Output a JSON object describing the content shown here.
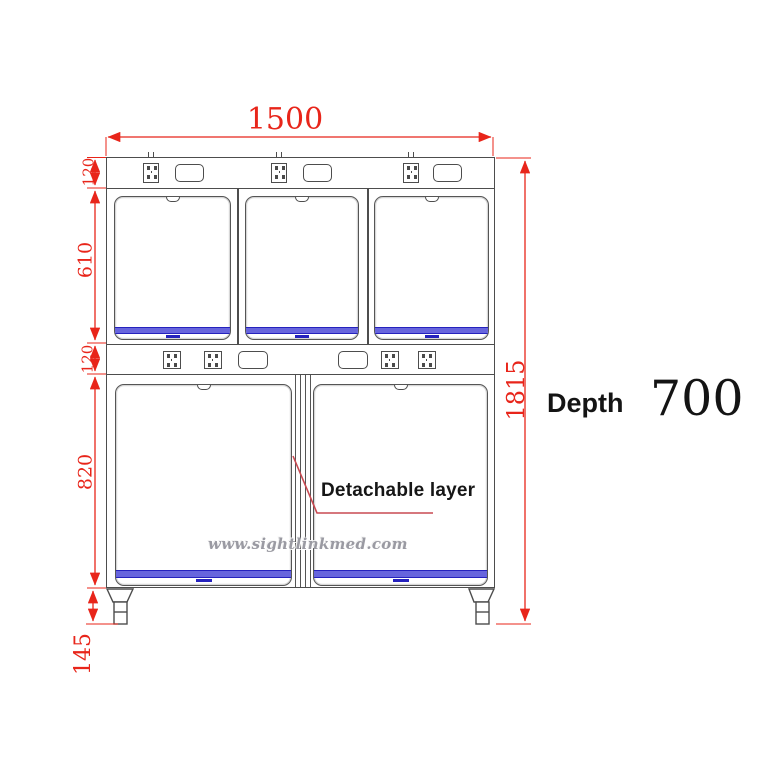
{
  "drawing": {
    "type": "technical-dimension-drawing",
    "subject": "veterinary cage bank, front elevation",
    "dimensions": {
      "total_width": "1500",
      "top_panel_height": "120",
      "upper_cage_height": "610",
      "middle_panel_height": "120",
      "lower_cage_height": "820",
      "leg_height": "145",
      "total_height": "1815"
    },
    "depth": {
      "label": "Depth",
      "value": "700"
    },
    "callout": "Detachable layer",
    "watermark": "www.sightlinkmed.com",
    "icons": {
      "socket": "power-socket-icon",
      "vent": "vent-panel-icon",
      "latch": "door-latch-notch"
    },
    "colors": {
      "dimension_red": "#e8251a",
      "line_gray": "#4d4d4d",
      "tray_blue_fill": "#6765dd",
      "tray_blue_line": "#2522bd"
    }
  }
}
